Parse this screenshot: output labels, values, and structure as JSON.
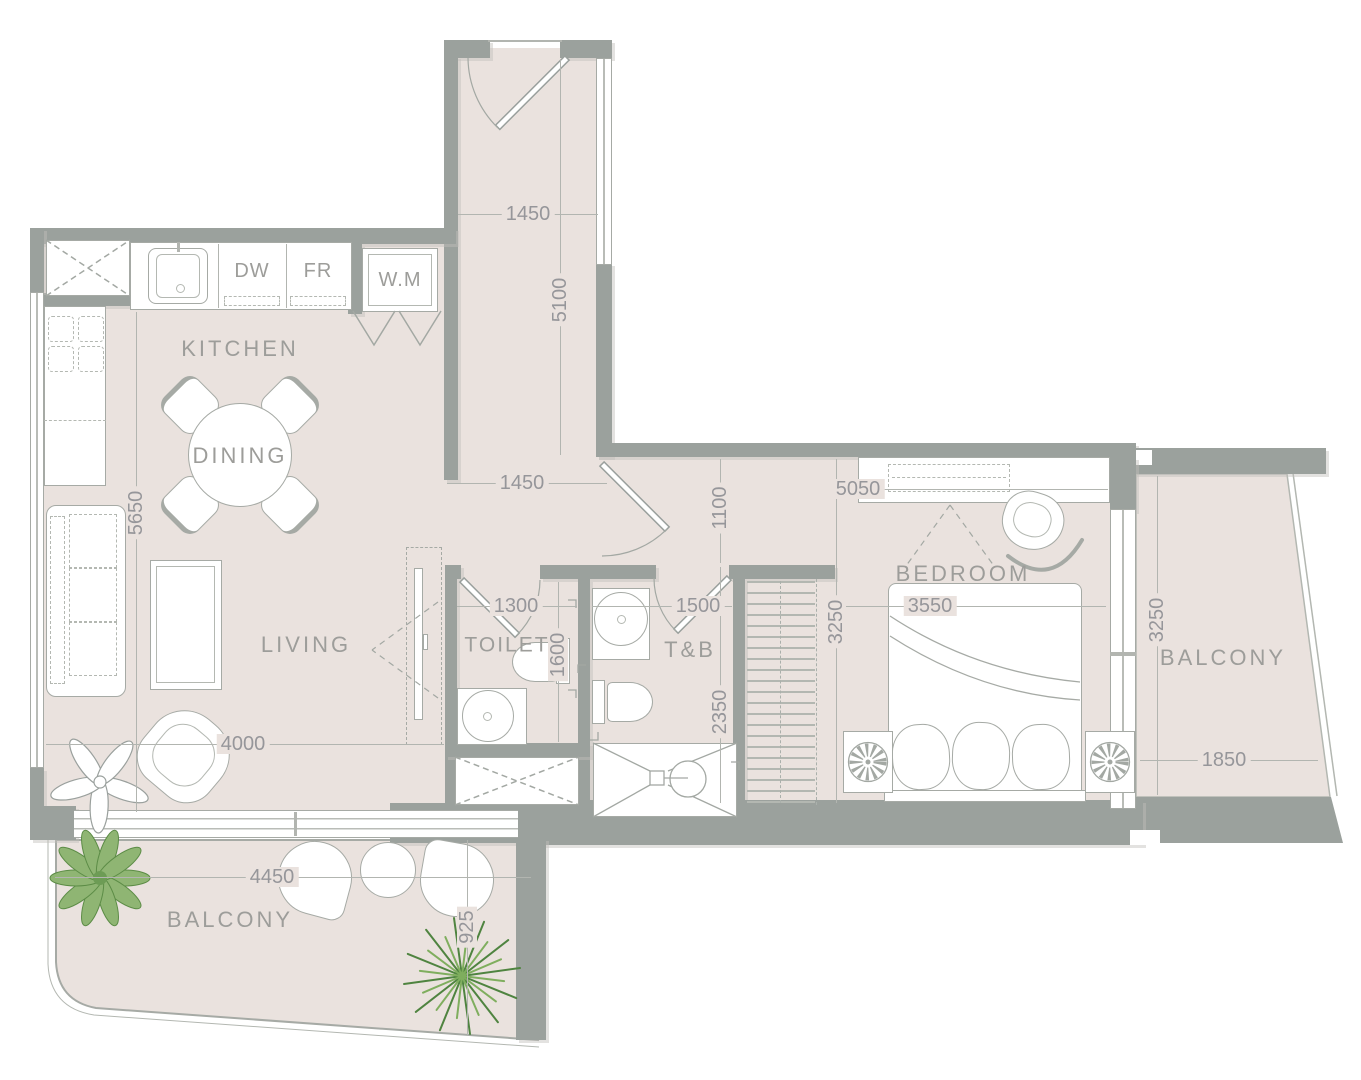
{
  "meta": {
    "type": "apartment-floor-plan"
  },
  "rooms": {
    "kitchen": "KITCHEN",
    "dining": "DINING",
    "living": "LIVING",
    "toilet": "TOILET",
    "tb": "T&B",
    "bedroom": "BEDROOM",
    "balcony_right": "BALCONY",
    "balcony_bottom": "BALCONY"
  },
  "appliances": {
    "dw": "DW",
    "fr": "FR",
    "wm": "W.M"
  },
  "dims": {
    "corridor_w": "1450",
    "corridor_h": "5100",
    "hall_w": "1450",
    "hall_h": "1100",
    "bedroom_top": "5050",
    "kitchen_h": "5650",
    "toilet_w": "1300",
    "toilet_h": "1600",
    "tb_w": "1500",
    "tb_h": "2350",
    "bed_w": "3550",
    "bedroom_h": "3250",
    "living_w": "4000",
    "balcony_right_w": "1850",
    "balcony_right_h": "3250",
    "balcony_bottom_w": "4450",
    "balcony_bottom_h": "925"
  },
  "colors": {
    "floor": "#eae2de",
    "wall": "#9ba19d",
    "line": "#a6aaa5",
    "text": "#9d9d9a",
    "plant_dark": "#4f8440",
    "plant_light": "#7fae5e"
  }
}
